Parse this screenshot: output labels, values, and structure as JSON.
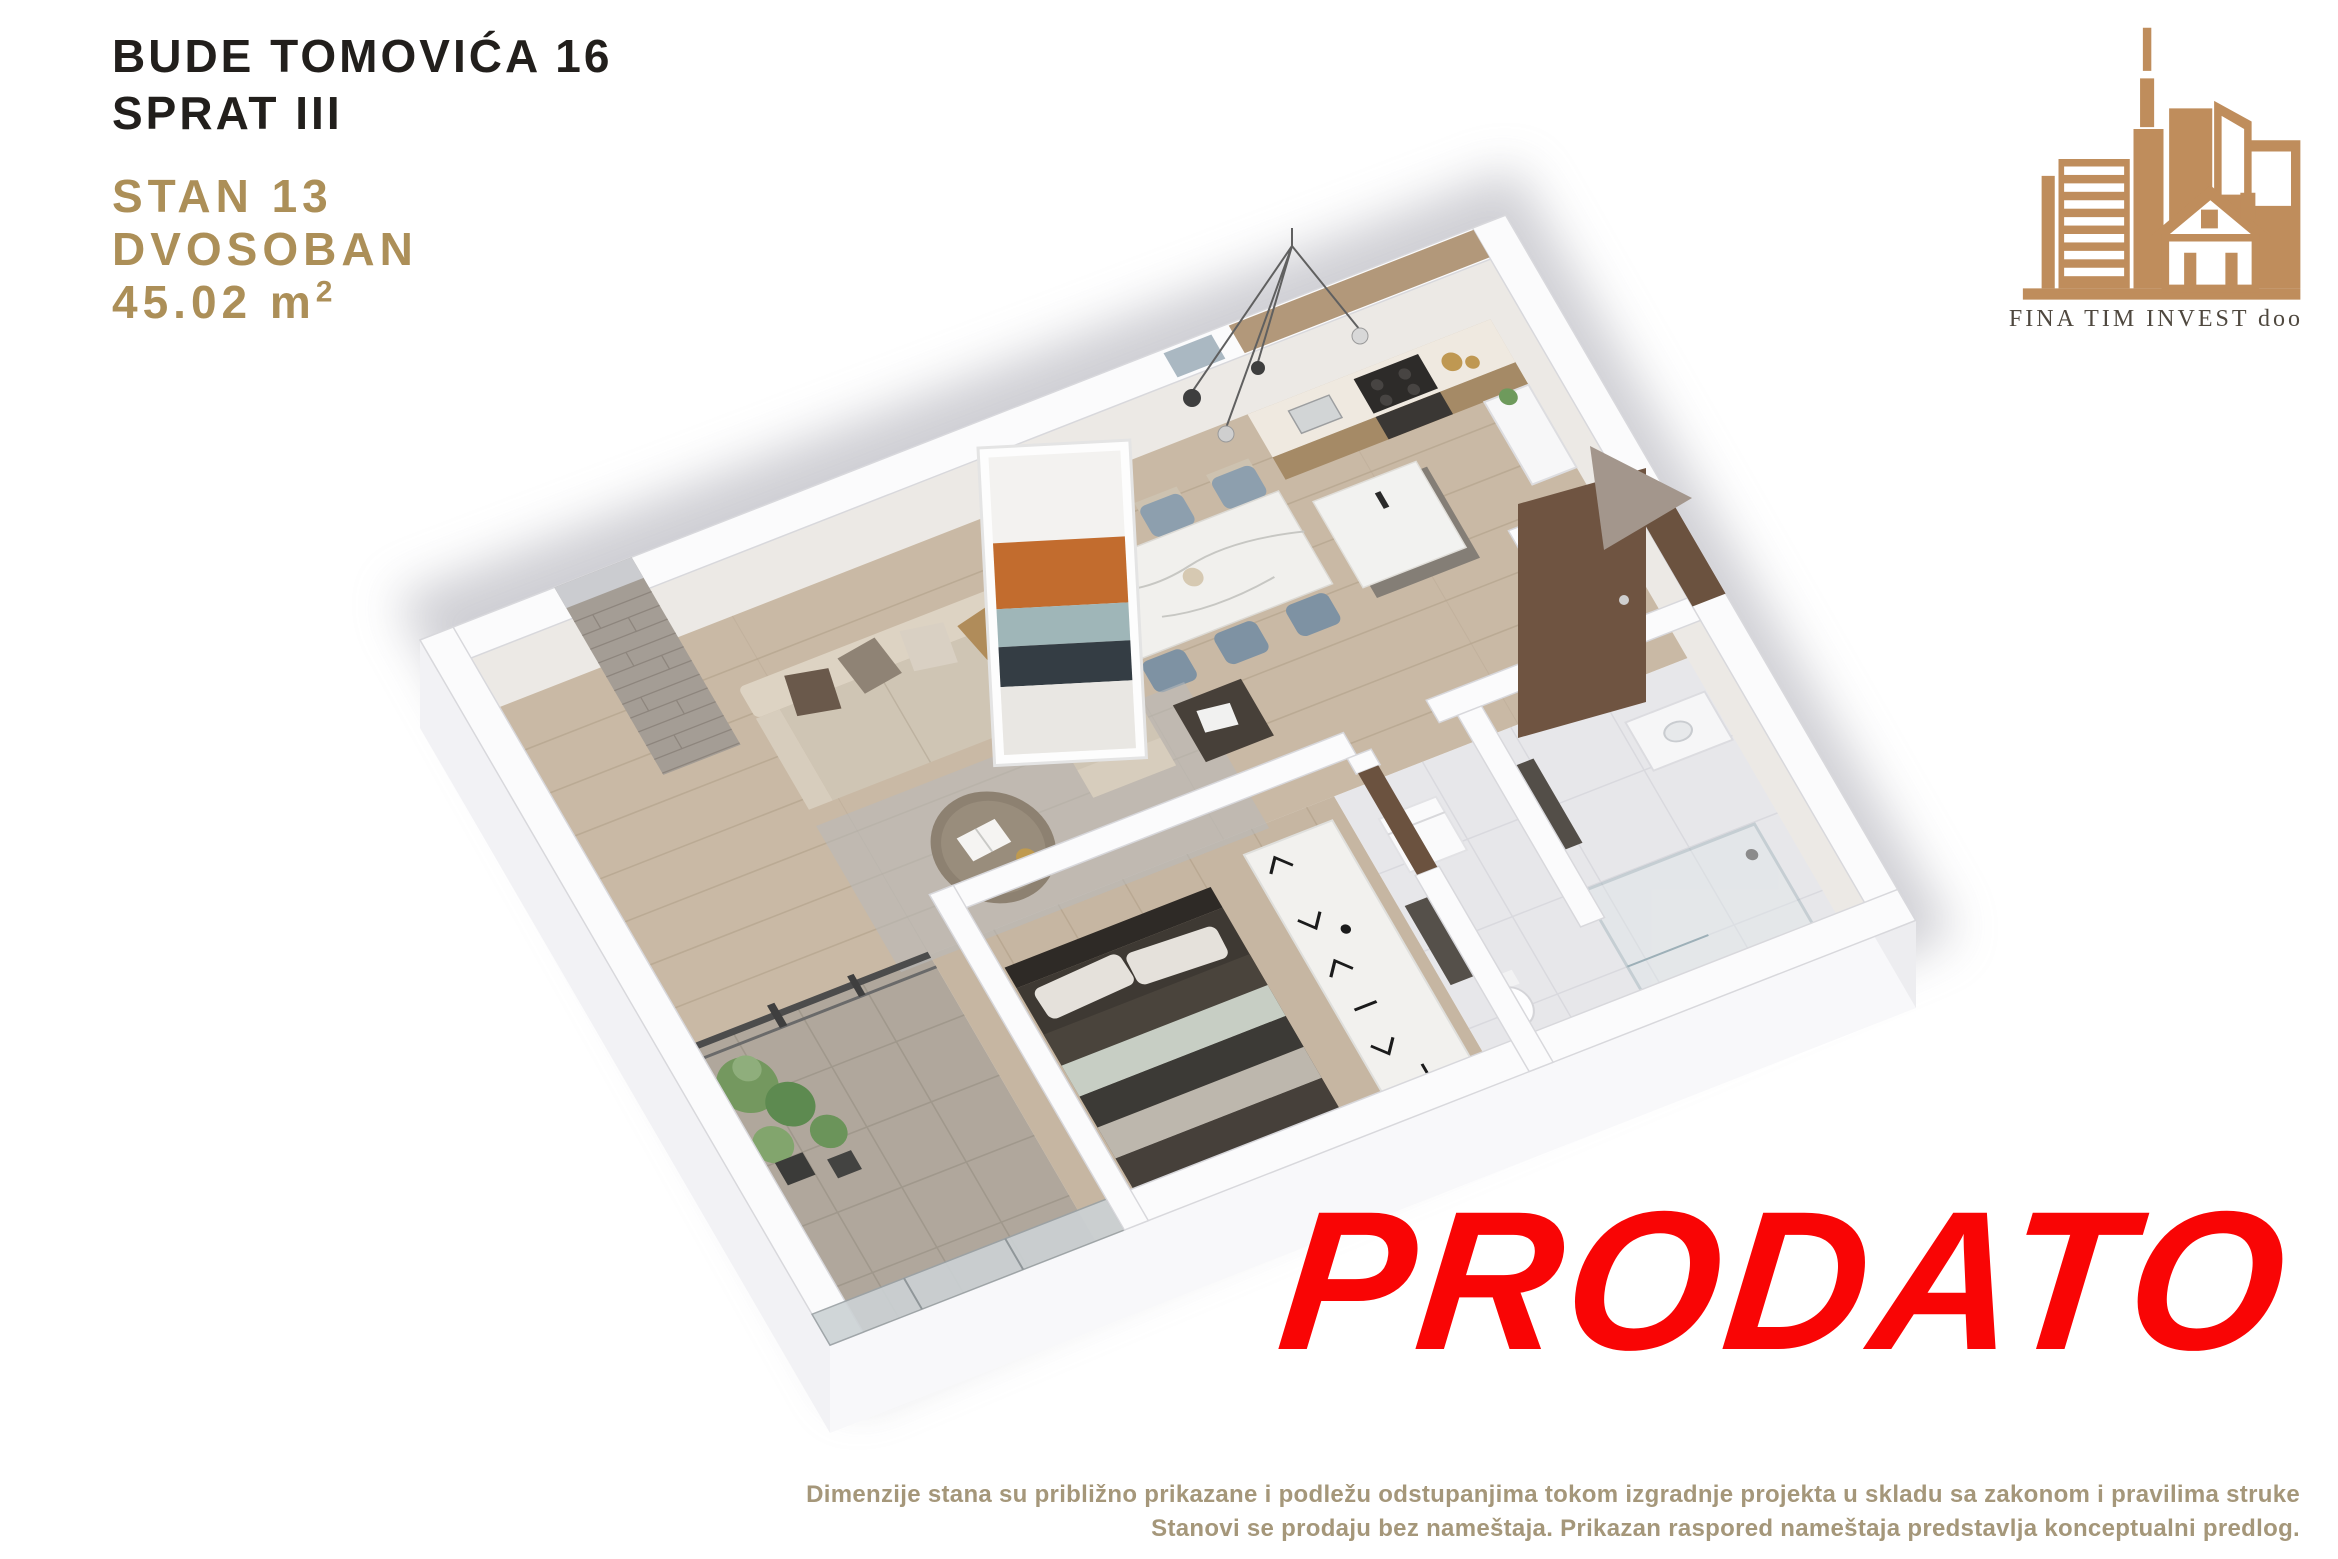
{
  "header": {
    "address_line1": "BUDE TOMOVIĆA 16",
    "address_line2": "SPRAT III",
    "unit_number": "STAN 13",
    "unit_type": "DVOSOBAN",
    "area_main": "45.02 m",
    "area_sup": "2"
  },
  "logo": {
    "company_name": "FINA TIM INVEST doo"
  },
  "status_stamp": {
    "label": "PRODATO"
  },
  "disclaimer": {
    "line1": "Dimenzije stana su približno prikazane i podležu odstupanjima tokom izgradnje projekta u skladu sa zakonom i pravilima struke",
    "line2": "Stanovi se prodaju bez nameštaja. Prikazan raspored nameštaja predstavlja konceptualni predlog."
  },
  "colors": {
    "accent_gold": "#ac8f58",
    "text_dark": "#221f1c",
    "logo_tan": "#bf8d5c",
    "logo_text": "#4f483f",
    "stamp_red": "#f90505",
    "disclaimer_gold": "#a5977a",
    "floor_wood": "#c9b9a5",
    "terrace_stone": "#b0a79c",
    "wall_white": "#fbfbfc",
    "door_brown": "#6b523f",
    "arrow_taupe": "#a3968c",
    "shadow_gray": "#a9a9b2"
  }
}
